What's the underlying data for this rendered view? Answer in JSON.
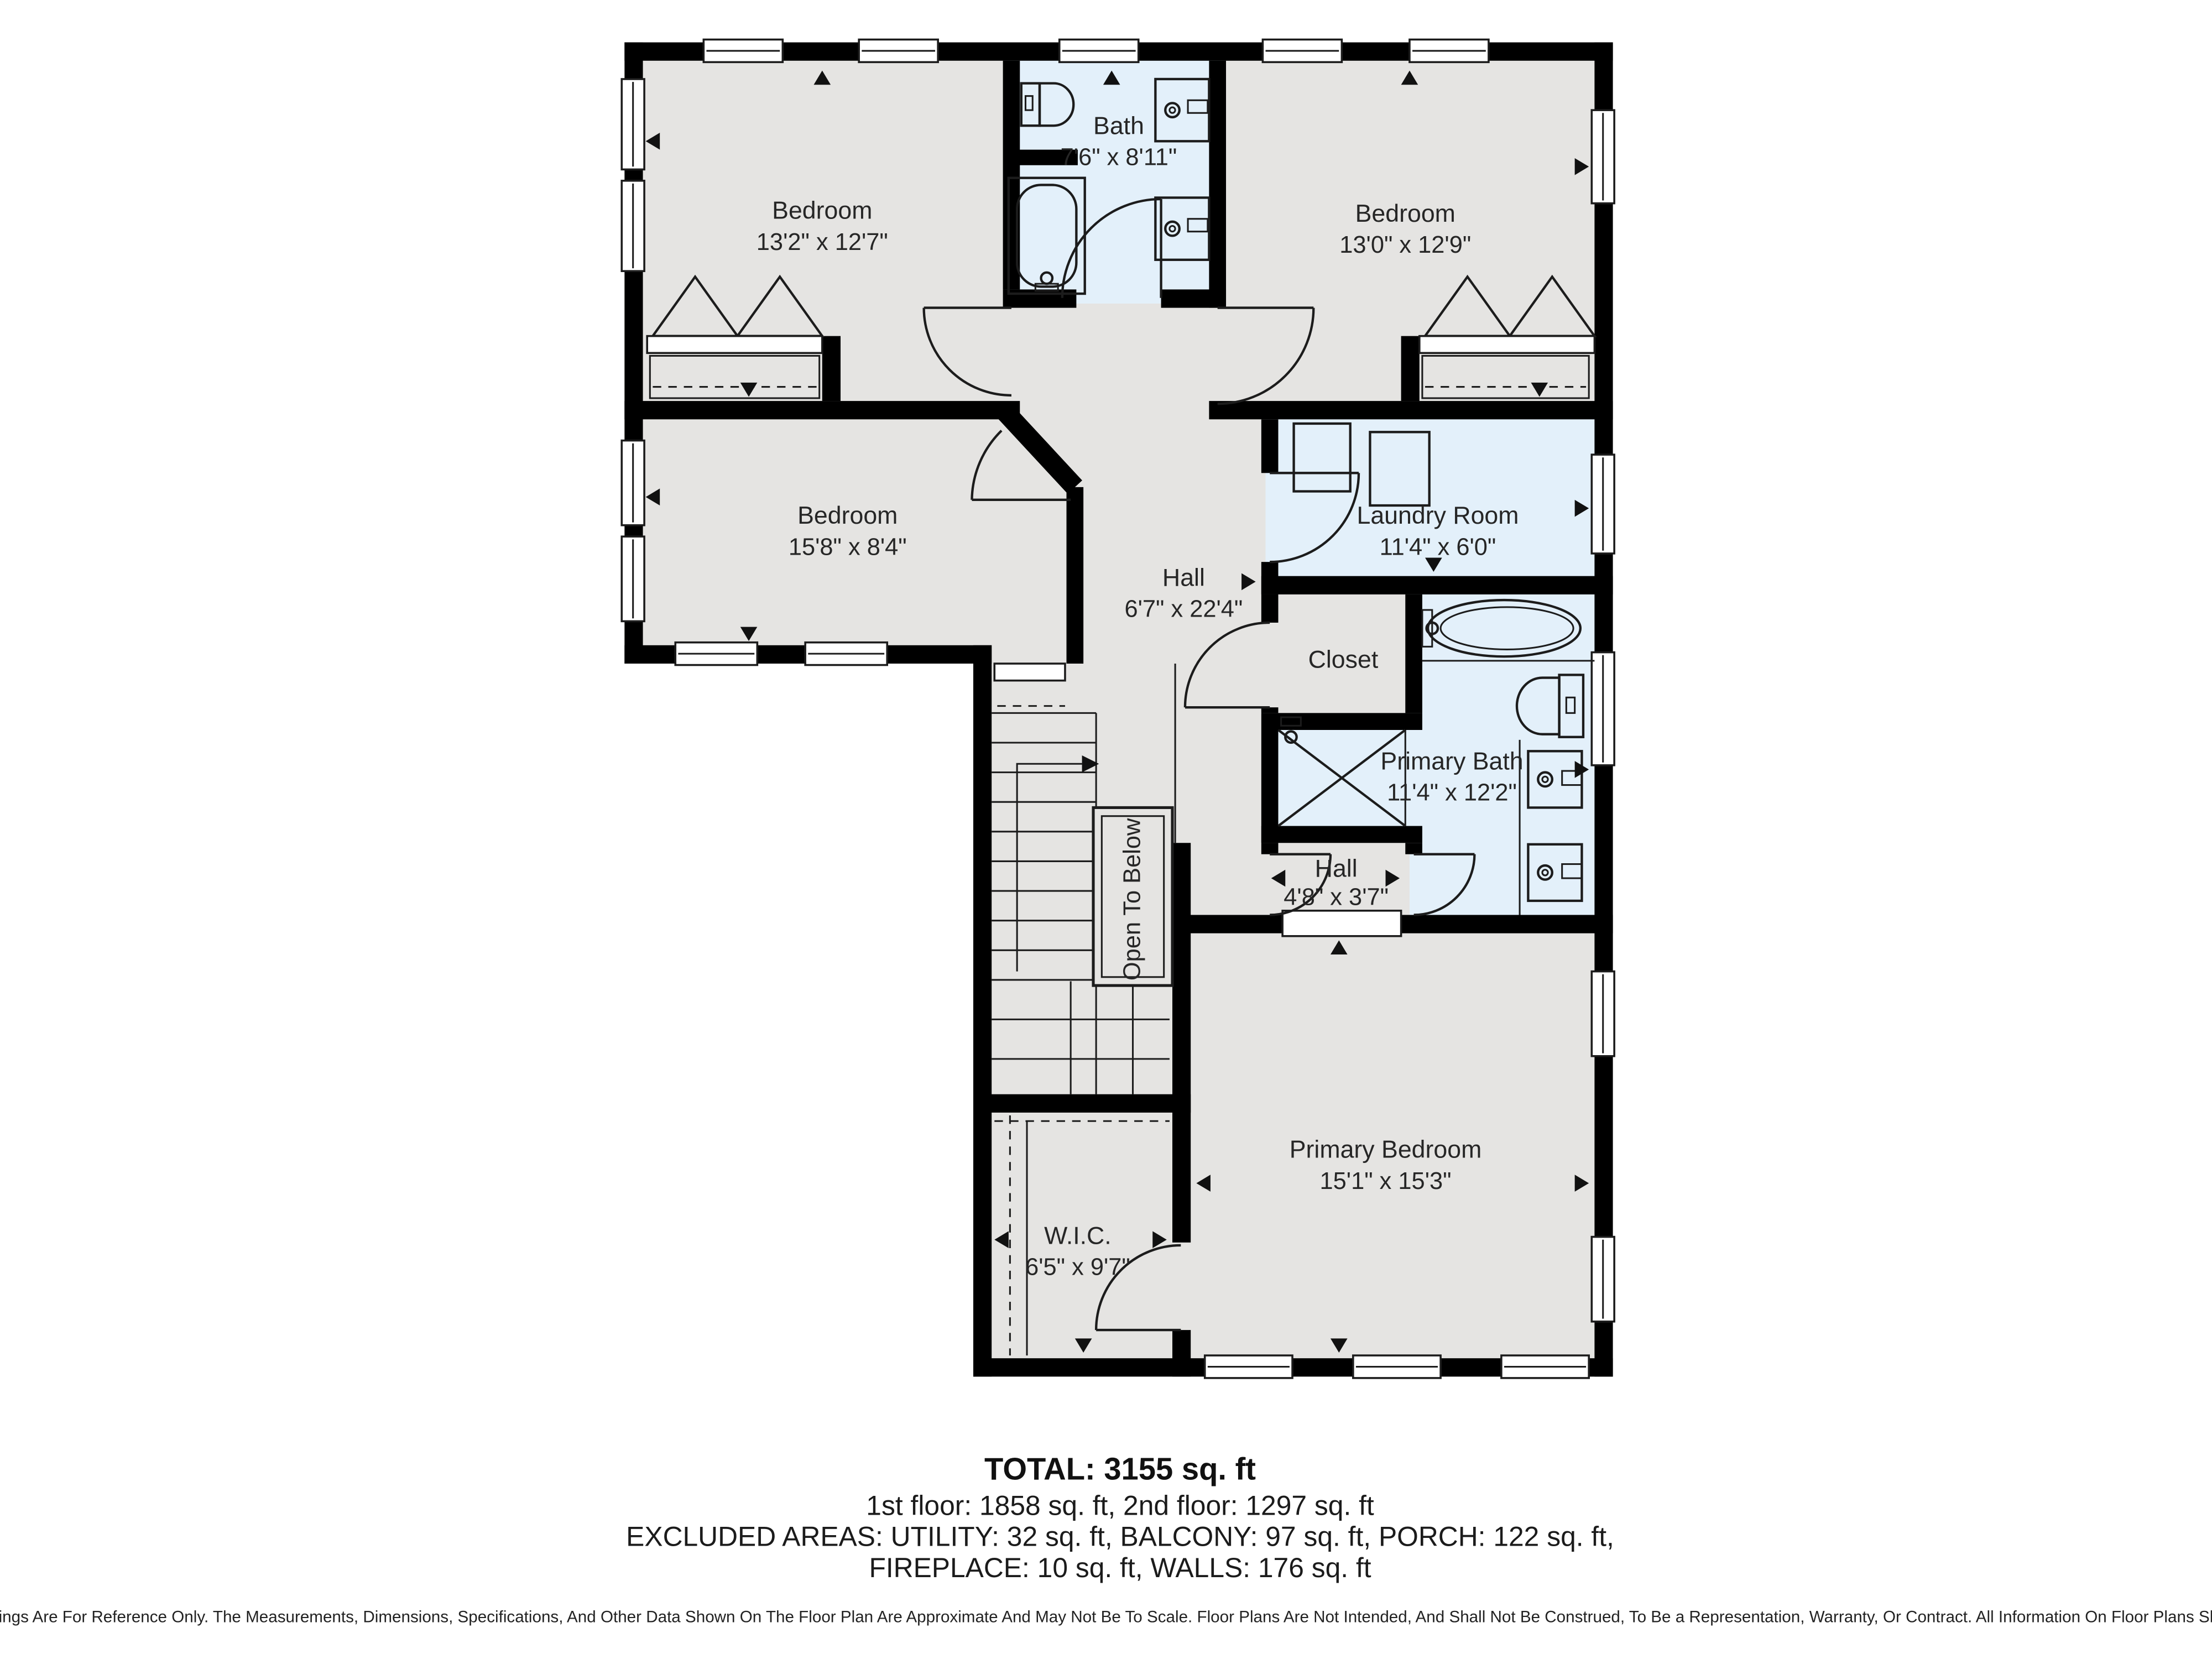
{
  "rooms": {
    "bedroom_top_left": {
      "label": "Bedroom",
      "dims": "13'2\" x 12'7\""
    },
    "bath": {
      "label": "Bath",
      "dims": "7'6\" x 8'11\""
    },
    "bedroom_top_right": {
      "label": "Bedroom",
      "dims": "13'0\" x 12'9\""
    },
    "bedroom_mid_left": {
      "label": "Bedroom",
      "dims": "15'8\" x 8'4\""
    },
    "hall": {
      "label": "Hall",
      "dims": "6'7\" x 22'4\""
    },
    "laundry": {
      "label": "Laundry Room",
      "dims": "11'4\" x 6'0\""
    },
    "closet": {
      "label": "Closet"
    },
    "primary_bath": {
      "label": "Primary Bath",
      "dims": "11'4\" x 12'2\""
    },
    "hall_small": {
      "label": "Hall",
      "dims": "4'8\" x 3'7\""
    },
    "open_to_below": {
      "label": "Open To Below"
    },
    "wic": {
      "label": "W.I.C.",
      "dims": "6'5\" x 9'7\""
    },
    "primary_bedroom": {
      "label": "Primary Bedroom",
      "dims": "15'1\" x 15'3\""
    }
  },
  "summary": {
    "total": "TOTAL: 3155 sq. ft",
    "floors": "1st floor: 1858 sq. ft, 2nd floor: 1297 sq. ft",
    "excluded_line1": "EXCLUDED AREAS: UTILITY: 32 sq. ft, BALCONY: 97 sq. ft, PORCH: 122 sq. ft,",
    "excluded_line2": "FIREPLACE: 10 sq. ft, WALLS: 176 sq. ft"
  },
  "disclaimer": "Floor Plans Provided In Our Listings Are For Reference Only. The Measurements, Dimensions, Specifications, And Other Data Shown On The Floor Plan Are Approximate And May Not Be To Scale. Floor Plans Are Not Intended, And Shall Not Be Construed, To Be a Representation, Warranty, Or Contract. All Information On Floor Plans Should Be Independently Verified.",
  "colors": {
    "room_gray": "#e5e4e2",
    "room_blue": "#e3f0fa",
    "wall": "#000000",
    "line": "#1c1c1c"
  }
}
